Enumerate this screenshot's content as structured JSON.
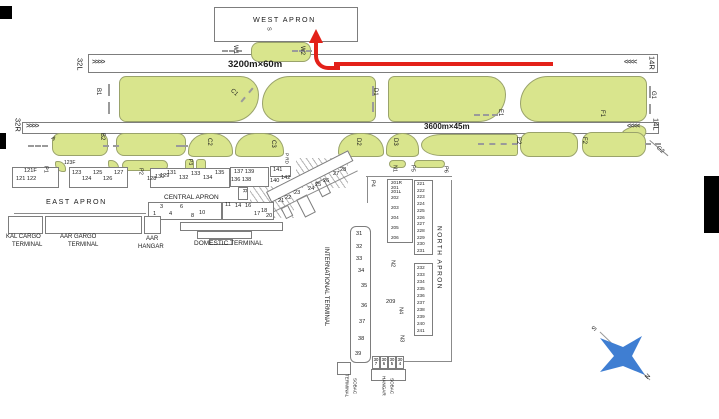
{
  "runways": {
    "north": {
      "label_left": "32L",
      "label_right": "14R",
      "dimensions": "3200m×60m"
    },
    "south": {
      "label_left": "32R",
      "label_right": "14L",
      "dimensions": "3600m×45m"
    },
    "chevrons_right": ">>>>",
    "chevrons_left": "<<<<"
  },
  "aprons": {
    "west": "WEST APRON",
    "east": "EAST APRON",
    "central": "CENTRAL APRON",
    "north": "NORTH APRON"
  },
  "terminals": {
    "kal_cargo": [
      "KAL CARGO",
      "TERMINAL"
    ],
    "aar_cargo": [
      "AAR GARGO",
      "TERMINAL"
    ],
    "aar_hangar": [
      "AAR",
      "HANGAR"
    ],
    "domestic": "DOMESTIC TERMINAL",
    "international": "INTERNATIONAL TERMINAL",
    "sobac_terminal": [
      "SOBAC",
      "TERMINAL"
    ],
    "sobac_hangar": [
      "SOBAC",
      "HANGAR"
    ]
  },
  "taxiways": {
    "a": "A",
    "b1": "B1",
    "b2": "B2",
    "c1": "C1",
    "c2": "C2",
    "c3": "C3",
    "d1": "D1",
    "d2": "D2",
    "d3": "D3",
    "e1": "E1",
    "e2": "E2",
    "f1": "F1",
    "f2": "F2",
    "g1": "G1",
    "g2": "G2",
    "w1": "W1",
    "w2": "W2",
    "p1": "P1",
    "p2": "P2",
    "p3": "P3",
    "p4": "P4",
    "p5": "P5",
    "p6": "P6",
    "n1": "N1",
    "n2": "N2",
    "n3": "N3",
    "n4": "N4",
    "r": "R",
    "s": "S",
    "p_rd": "P RD"
  },
  "stands": {
    "east_121": [
      "121F",
      "121 122"
    ],
    "east_123f": "123F",
    "east_123": [
      "123",
      "124",
      "125",
      "126",
      "127"
    ],
    "east_128": [
      "128",
      "129"
    ],
    "central_130": [
      "130",
      "131",
      "132",
      "133",
      "134",
      "135"
    ],
    "central_137": [
      "137 139",
      "136 138"
    ],
    "central_141": [
      "141",
      "140",
      "142"
    ],
    "domestic": [
      "1",
      "3",
      "4",
      "6",
      "8",
      "10",
      "11",
      "14",
      "16",
      "17",
      "18",
      "20"
    ],
    "intl_row": [
      "21",
      "22",
      "23",
      "24",
      "25",
      "26",
      "27",
      "28"
    ],
    "intl_col": [
      "31",
      "32",
      "33",
      "34",
      "35",
      "36",
      "37",
      "38",
      "39"
    ],
    "north_201": [
      "201R",
      "201",
      "201L",
      "202",
      "203",
      "204",
      "205",
      "206"
    ],
    "north_209": "209",
    "north_221": [
      "221",
      "222",
      "223",
      "224",
      "225",
      "226",
      "227",
      "228",
      "229",
      "230",
      "231"
    ],
    "north_232": [
      "232",
      "233",
      "234",
      "235",
      "236",
      "237",
      "238",
      "239",
      "240",
      "241"
    ],
    "sobac": [
      "307",
      "306",
      "305",
      "304"
    ]
  },
  "compass": {
    "north": "N",
    "south": "S"
  },
  "colors": {
    "island": "#d9e58d",
    "arrow": "#e32119",
    "compass_blue": "#3f7ed2"
  }
}
